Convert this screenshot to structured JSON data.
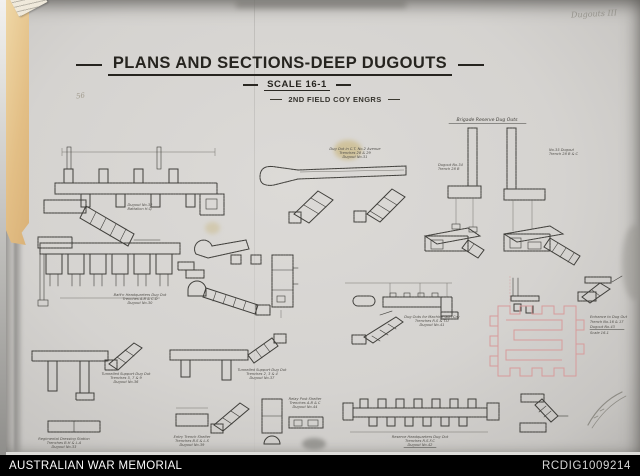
{
  "archive_bar": {
    "left_text": "AUSTRALIAN WAR MEMORIAL",
    "right_text": "RCDIG1009214",
    "bg_color": "#000000",
    "text_color": "#fafafa"
  },
  "sheet": {
    "title": "PLANS AND SECTIONS-DEEP DUGOUTS",
    "scale_label": "SCALE 16-1",
    "unit_label": "2ND FIELD COY ENGRS",
    "handwritten_note": "Dugouts III",
    "pencil_note": "56",
    "colors": {
      "paper": "#d5d3d0",
      "ink": "#3f3e3a",
      "pink_ink": "#d79b9b",
      "tape": "#e3bf86",
      "footer_bg": "#000000"
    }
  },
  "drawings": {
    "battalion_plan": {
      "caption": [
        "Dugout No.32",
        "Battalion H.Q."
      ]
    },
    "avenue_tunnel": {
      "caption": [
        "Dug Out in C.T. No.2 Avenue",
        "Trenches 28 & 29",
        "Dugout No.31"
      ]
    },
    "brigade_reserve": {
      "heading": "Brigade Reserve Dug Outs",
      "left_label": [
        "Dugout No.34",
        "Trench 28 B"
      ],
      "right_label": [
        "No.35 Dugout",
        "Trench 28 B & C"
      ]
    },
    "ordnance_plan": {
      "caption": [
        "Batt'n Headquarters Dug Out",
        "Trenches A.B & C.D",
        "Dugout No.30"
      ]
    },
    "machine_gun": {
      "caption": [
        "Dug Outs for Machine Gun Coy",
        "Trenches R.S & T.U",
        "Dugout No.41"
      ]
    },
    "engineers_maze": {
      "caption": [
        "Entrance to Dug Out",
        "Trench No.16 & 17",
        "Dugout No.43",
        "Scale 16-1"
      ]
    },
    "t_plan_left": {
      "caption": [
        "Tunnelled Support Dug Out",
        "Trenches 5, 7 & 9",
        "Dugout No.36"
      ]
    },
    "t_plan_right": {
      "caption": [
        "Tunnelled Support Dug Out",
        "Trenches 2, 3 & 4",
        "Dugout No.37"
      ]
    },
    "dressing_station": {
      "caption": [
        "Regimental Dressing Station",
        "Trenches B.H & L.A",
        "Dugout No.33"
      ]
    },
    "entry_shelter": {
      "caption": [
        "Entry Trench Shelter",
        "Trenches B.S & L.S",
        "Dugout No.39"
      ]
    },
    "relay_shelter": {
      "caption": [
        "Relay Post Shelter",
        "Trenches A.B & C",
        "Dugout No.44"
      ]
    },
    "reserve_comb": {
      "caption": [
        "Reserve Headquarters Dug Out",
        "Trenches R.S.F.C",
        "Dugout No.42"
      ]
    }
  }
}
